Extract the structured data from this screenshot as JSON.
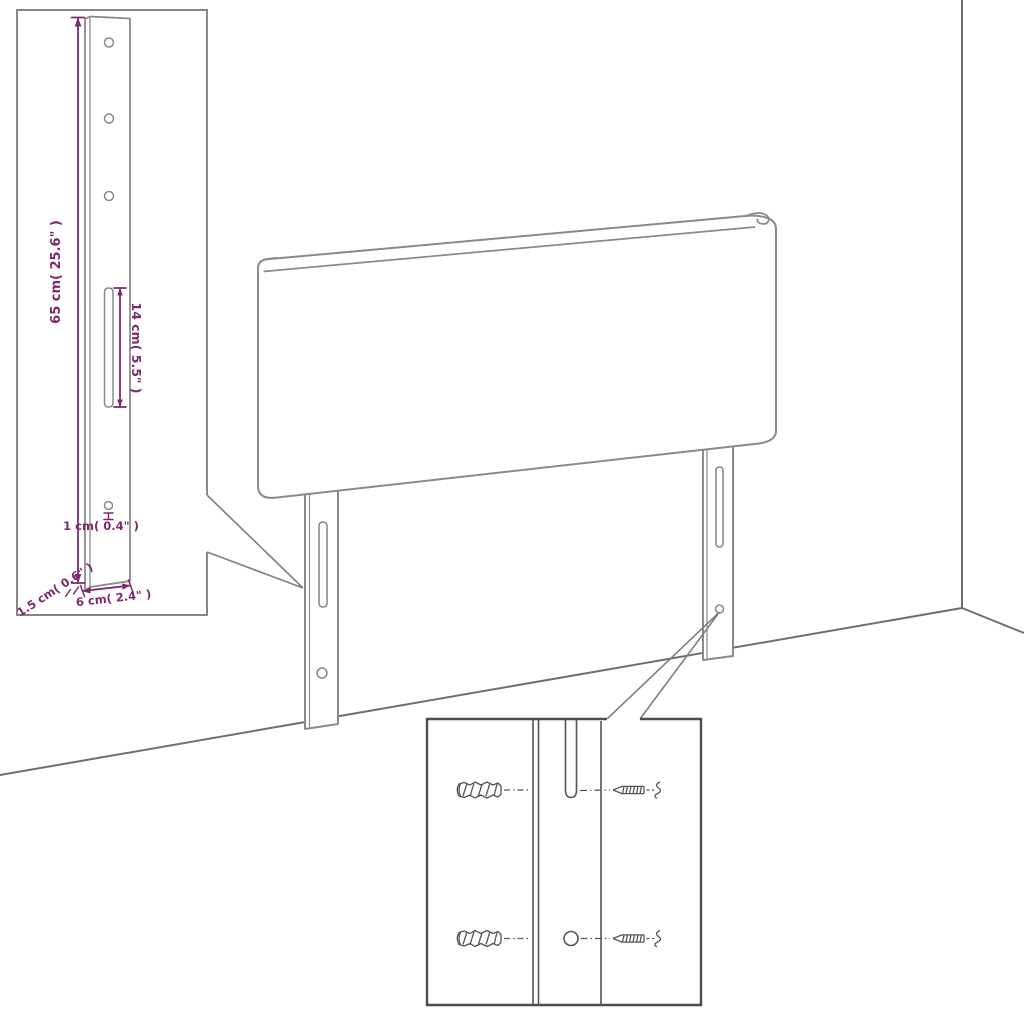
{
  "diagram": {
    "title": "Headboard assembly dimension diagram",
    "subject": "Upholstered headboard panel with two mounting legs, shown in a room corner with wall and floor lines",
    "insets": {
      "leg_detail": "Enlarged mounting leg with three screw holes, adjustment slot and bottom hole",
      "wall_fixing_detail": "Wall plugs and screws aligned with the leg slot and round hole"
    }
  },
  "dimensions": {
    "leg_height": "65 cm( 25.6\" )",
    "slot_length": "14 cm( 5.5\" )",
    "hole_size": "1 cm( 0.4\" )",
    "leg_thickness": "1.5 cm( 0.6\" )",
    "leg_width": "6 cm( 2.4\" )"
  },
  "colors": {
    "dimension_accent": "#7d2a6c",
    "drawing_line": "#8a8a8a",
    "detail_line": "#555555",
    "wall_line": "#6f6f6f",
    "callout_border": "#4d4d4d",
    "inset_border": "#757575",
    "background": "#ffffff"
  }
}
